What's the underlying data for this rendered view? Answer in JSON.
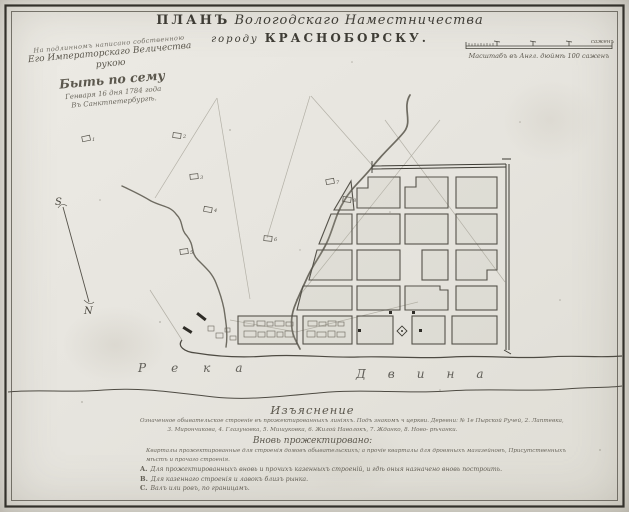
{
  "palette": {
    "paper": "#e8e6e0",
    "ink": "#43413a",
    "faint": "#b0ada3",
    "hand": "#5b574d"
  },
  "title": {
    "plan": "ПЛАНЪ",
    "territory": "Вологодскаго Наместничества",
    "town_pre": "городу",
    "town": "КРАСНОБОРСКУ."
  },
  "imperial_note": {
    "line1": "На подлинномъ написано собственною",
    "line2": "Его Императорскаго Величества рукою",
    "line3": "Быть по сему",
    "line4": "Генваря 16 дня 1784 года",
    "line5": "Въ Санктпетербургѣ."
  },
  "scale_bar": {
    "caption": "Масштабъ въ Англ. дюймѣ 100 саженъ",
    "unit_label": "саженъ"
  },
  "compass": {
    "south": "S",
    "north": "N"
  },
  "map": {
    "river_label_1": "Река",
    "river_label_2": "Двина",
    "hamlet_numbers": [
      "1",
      "2",
      "3",
      "4",
      "5",
      "6",
      "7",
      "8"
    ]
  },
  "explanation": {
    "heading": "Изъяснение",
    "line1": "Означенное обывательское строеніе въ прожектированныхъ линіяхъ. Подъ знакомъ ч церкви. Деревни: № 1е Пырской Ручей, 2. Лаптевка,",
    "line2": "3. Мирончикова, 4. Глазуновка, 5. Мишуковка, 6. Жилой Наволокъ, 7. Жданко, 8. Ново- рѣчанки.",
    "subheading": "Вновь прожектировано:",
    "line3": "Кварталы прожектированные для строенія домовъ обывательскихъ; а прочіе кварталы для дровяныхъ магазейновъ, Присутственныхъ",
    "line4": "мѣстъ и прочаго строенія.",
    "items": [
      {
        "key": "A.",
        "text": "Для прожектированныхъ вновь и прочихъ казенныхъ строеній, и гдѣ оныя назначено вновь построить."
      },
      {
        "key": "B.",
        "text": "Для казеннаго строенія и лавокъ близъ рынка."
      },
      {
        "key": "C.",
        "text": "Валъ или ровъ, по границамъ."
      }
    ]
  }
}
